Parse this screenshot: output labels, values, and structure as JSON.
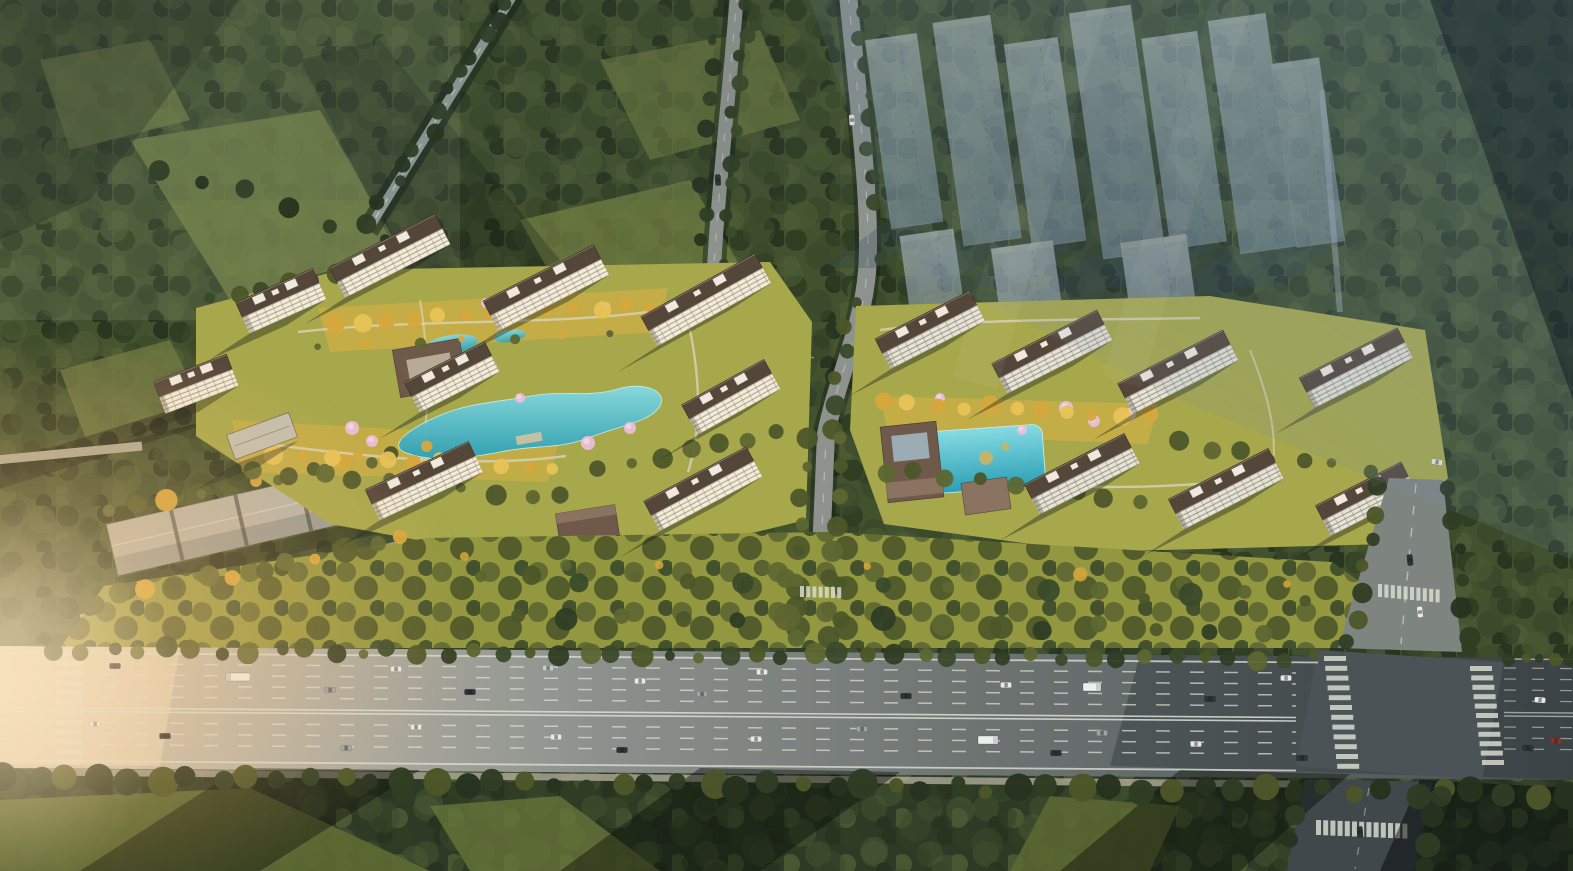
{
  "meta": {
    "description": "Aerial dusk rendering of a residential development: two clusters of high-rise apartment towers with dark hip roofs around landscaped courtyard gardens with serpentine turquoise ponds, golden trees and pink blossom trees; translucent phase-two tower massing at upper right; dense forest surroundings; long low storage rows at left; a wide multi-lane highway across the bottom with cars, trucks and zebra crosswalks, and a signalized intersection at the right; warm low sunlight from the left."
  },
  "palette": {
    "forest_base": "#42512e",
    "forest_deep": "#2f3d24",
    "forest_shade": "#27331f",
    "forest_mid": "#3a4a2a",
    "forest_light": "#4a5a33",
    "forest_south": "#2c3a26",
    "meadow": "#6d7a41",
    "canopy_olive": "#5d6632",
    "canopy_dark": "#4c5629",
    "tree_gold": "#d7a63c",
    "tree_gold_light": "#e7c257",
    "blossom": "#e9c0da",
    "blossom_light": "#f3d6e8",
    "lawn": "#a7a74b",
    "lawn_gold": "#c9ae45",
    "park": "#93973f",
    "grass_south": "#5d6a33",
    "pond_hi": "#86dbe2",
    "pond_lo": "#2b9fb6",
    "facade_warm": "#f3ecda",
    "facade_cool": "#e7e3d6",
    "facade_line": "#9f9580",
    "roof_brown": "#55463a",
    "roof_dark": "#3a2f27",
    "roof_box": "#efeadd",
    "podium": "#c3bfae",
    "garage_roof": "#b6b4a8",
    "garage_shade": "#8e948f",
    "gate_brown": "#6e594a",
    "gate_light": "#8a7361",
    "road": "#8d928e",
    "road_pale": "#b8b2a2",
    "canal": "#8d9a94",
    "hw_left": "#d8cfba",
    "hw_mid": "#8d918d",
    "hw_right": "#4a5254",
    "intersection": "#4b5356",
    "lane": "#dcdfd3",
    "ghost_hi": "#c7d2da",
    "ghost_lo": "#8196a9",
    "ghost_shadow": "#2c3e52",
    "car_white": "#e9ebe3",
    "car_dark": "#2d3336",
    "car_gray": "#9da3a4",
    "car_silver": "#c6cac8",
    "car_red": "#8a3430",
    "glow": "#ffc98a",
    "haze": "#6e8cab"
  },
  "scene": {
    "towers": [
      {
        "x": 390,
        "y": 256,
        "l": 118,
        "rot": -27,
        "s": "warm"
      },
      {
        "x": 546,
        "y": 288,
        "l": 124,
        "rot": -27,
        "s": "warm"
      },
      {
        "x": 706,
        "y": 300,
        "l": 130,
        "rot": -29,
        "s": "warm"
      },
      {
        "x": 281,
        "y": 301,
        "l": 84,
        "rot": -24,
        "s": "warm"
      },
      {
        "x": 196,
        "y": 384,
        "l": 78,
        "rot": -21,
        "s": "warm"
      },
      {
        "x": 452,
        "y": 377,
        "l": 90,
        "rot": -27,
        "s": "warm"
      },
      {
        "x": 731,
        "y": 397,
        "l": 94,
        "rot": -29,
        "s": "warm"
      },
      {
        "x": 424,
        "y": 481,
        "l": 114,
        "rot": -25,
        "s": "warm"
      },
      {
        "x": 703,
        "y": 489,
        "l": 116,
        "rot": -28,
        "s": "warm"
      },
      {
        "x": 262,
        "y": 436,
        "l": 66,
        "rot": -20,
        "s": "podium"
      },
      {
        "x": 930,
        "y": 330,
        "l": 106,
        "rot": -27,
        "s": "cool"
      },
      {
        "x": 1052,
        "y": 352,
        "l": 118,
        "rot": -27,
        "s": "cool"
      },
      {
        "x": 1178,
        "y": 372,
        "l": 118,
        "rot": -27,
        "s": "cool"
      },
      {
        "x": 1356,
        "y": 368,
        "l": 110,
        "rot": -27,
        "s": "cool"
      },
      {
        "x": 1082,
        "y": 474,
        "l": 112,
        "rot": -27,
        "s": "cool"
      },
      {
        "x": 1226,
        "y": 489,
        "l": 112,
        "rot": -27,
        "s": "cool"
      },
      {
        "x": 1366,
        "y": 499,
        "l": 96,
        "rot": -27,
        "s": "cool"
      }
    ],
    "ghost_towers": [
      [
        878,
        36,
        52,
        190
      ],
      [
        948,
        18,
        58,
        225
      ],
      [
        1018,
        40,
        54,
        205
      ],
      [
        1086,
        8,
        62,
        248
      ],
      [
        1156,
        34,
        56,
        212
      ],
      [
        1224,
        16,
        58,
        235
      ],
      [
        1284,
        60,
        48,
        185
      ],
      [
        1130,
        238,
        66,
        140
      ],
      [
        1000,
        244,
        62,
        132
      ],
      [
        908,
        232,
        54,
        124
      ]
    ],
    "tree_rows": [
      {
        "layer": "roadside",
        "x0": 55,
        "y0": 649,
        "x1": 1315,
        "y1": 659,
        "n": 46,
        "r": 8,
        "j": 5,
        "colors": [
          "forest_mid",
          "canopy_dark",
          "forest_deep",
          "canopy_olive"
        ]
      },
      {
        "layer": "roadside",
        "x0": 1510,
        "y0": 660,
        "x1": 1570,
        "y1": 661,
        "n": 5,
        "r": 7,
        "j": 3,
        "colors": [
          "forest_deep",
          "canopy_dark"
        ]
      },
      {
        "layer": "roadside",
        "x0": 6,
        "y0": 778,
        "x1": 1568,
        "y1": 794,
        "n": 52,
        "r": 11,
        "j": 6,
        "colors": [
          "forest_shade",
          "forest_deep",
          "canopy_dark"
        ],
        "o": 0.98
      },
      {
        "layer": "forest",
        "x0": 508,
        "y0": 2,
        "x1": 372,
        "y1": 222,
        "n": 13,
        "r": 8,
        "j": 7,
        "colors": [
          "forest_deep",
          "forest_shade"
        ]
      },
      {
        "layer": "forest",
        "x0": 744,
        "y0": 6,
        "x1": 722,
        "y1": 288,
        "n": 12,
        "r": 7,
        "j": 6,
        "colors": [
          "forest_deep",
          "forest_mid"
        ]
      },
      {
        "layer": "forest",
        "x0": 712,
        "y0": 12,
        "x1": 700,
        "y1": 270,
        "n": 10,
        "r": 7,
        "j": 6,
        "colors": [
          "forest_shade",
          "forest_deep"
        ]
      },
      {
        "layer": "forest",
        "x0": 858,
        "y0": 8,
        "x1": 880,
        "y1": 258,
        "n": 10,
        "r": 7,
        "j": 6,
        "colors": [
          "forest_deep",
          "forest_mid"
        ]
      },
      {
        "layer": "forest",
        "x0": 852,
        "y0": 300,
        "x1": 830,
        "y1": 428,
        "n": 6,
        "r": 8,
        "j": 5,
        "colors": [
          "forest_mid",
          "canopy_dark"
        ]
      },
      {
        "layer": "forest",
        "x0": 6,
        "y0": 470,
        "x1": 212,
        "y1": 410,
        "n": 9,
        "r": 9,
        "j": 5,
        "colors": [
          "forest_shade",
          "forest_deep"
        ]
      },
      {
        "layer": "forest",
        "x0": 160,
        "y0": 170,
        "x1": 420,
        "y1": 250,
        "n": 7,
        "r": 8,
        "j": 10,
        "colors": [
          "forest_deep",
          "forest_shade"
        ]
      },
      {
        "layer": "garden",
        "x0": 840,
        "y0": 440,
        "x1": 830,
        "y1": 636,
        "n": 8,
        "r": 8,
        "j": 4,
        "colors": [
          "canopy_olive",
          "canopy_dark"
        ]
      },
      {
        "layer": "garden",
        "x0": 806,
        "y0": 440,
        "x1": 796,
        "y1": 636,
        "n": 8,
        "r": 8,
        "j": 4,
        "colors": [
          "canopy_dark",
          "canopy_olive"
        ]
      },
      {
        "layer": "garden",
        "x0": 112,
        "y0": 512,
        "x1": 424,
        "y1": 448,
        "n": 12,
        "r": 8,
        "j": 5,
        "colors": [
          "canopy_olive",
          "canopy_dark",
          "tree_gold"
        ]
      },
      {
        "layer": "garden",
        "x0": 92,
        "y0": 602,
        "x1": 402,
        "y1": 540,
        "n": 12,
        "r": 9,
        "j": 5,
        "colors": [
          "canopy_dark",
          "canopy_olive",
          "tree_gold"
        ]
      },
      {
        "layer": "garden",
        "x0": 214,
        "y0": 302,
        "x1": 336,
        "y1": 272,
        "n": 6,
        "r": 8,
        "j": 5,
        "colors": [
          "forest_mid",
          "canopy_dark"
        ]
      },
      {
        "layer": "garden",
        "x0": 252,
        "y0": 470,
        "x1": 564,
        "y1": 498,
        "n": 10,
        "r": 8,
        "j": 5,
        "colors": [
          "canopy_olive",
          "canopy_dark"
        ]
      },
      {
        "layer": "garden",
        "x0": 600,
        "y0": 470,
        "x1": 780,
        "y1": 432,
        "n": 7,
        "r": 8,
        "j": 5,
        "colors": [
          "canopy_dark",
          "canopy_olive"
        ]
      },
      {
        "layer": "garden",
        "x0": 884,
        "y0": 470,
        "x1": 1140,
        "y1": 500,
        "n": 9,
        "r": 8,
        "j": 5,
        "colors": [
          "canopy_olive",
          "canopy_dark"
        ]
      },
      {
        "layer": "garden",
        "x0": 1180,
        "y0": 442,
        "x1": 1366,
        "y1": 470,
        "n": 7,
        "r": 8,
        "j": 5,
        "colors": [
          "canopy_dark",
          "canopy_olive"
        ]
      },
      {
        "layer": "south",
        "x0": 480,
        "y0": 575,
        "x1": 1300,
        "y1": 598,
        "n": 17,
        "r": 9,
        "j": 7,
        "colors": [
          "canopy_olive",
          "canopy_dark",
          "forest_mid"
        ]
      },
      {
        "layer": "south",
        "x0": 520,
        "y0": 612,
        "x1": 1260,
        "y1": 634,
        "n": 15,
        "r": 10,
        "j": 7,
        "colors": [
          "canopy_dark",
          "forest_deep",
          "canopy_olive"
        ]
      },
      {
        "layer": "gold",
        "x0": 334,
        "y0": 322,
        "x1": 654,
        "y1": 306,
        "n": 13,
        "r": 7,
        "j": 4,
        "colors": [
          "tree_gold",
          "tree_gold_light",
          "tree_gold"
        ]
      },
      {
        "layer": "gold",
        "x0": 246,
        "y0": 452,
        "x1": 556,
        "y1": 468,
        "n": 12,
        "r": 8,
        "j": 4,
        "colors": [
          "tree_gold",
          "tree_gold_light"
        ]
      },
      {
        "layer": "gold",
        "x0": 884,
        "y0": 402,
        "x1": 1148,
        "y1": 416,
        "n": 11,
        "r": 7,
        "j": 4,
        "colors": [
          "tree_gold",
          "tree_gold_light"
        ]
      },
      {
        "layer": "gold",
        "x0": 320,
        "y0": 345,
        "x1": 660,
        "y1": 330,
        "n": 8,
        "r": 5,
        "j": 5,
        "colors": [
          "canopy_olive",
          "tree_gold"
        ]
      },
      {
        "layer": "gold",
        "x0": 460,
        "y0": 556,
        "x1": 1280,
        "y1": 582,
        "n": 9,
        "r": 6,
        "j": 8,
        "colors": [
          "tree_gold",
          "canopy_olive"
        ],
        "o": 0.85
      },
      {
        "layer": "roadside",
        "x0": 1380,
        "y0": 486,
        "x1": 1350,
        "y1": 644,
        "n": 7,
        "r": 8,
        "j": 4,
        "colors": [
          "forest_deep",
          "canopy_dark"
        ]
      },
      {
        "layer": "roadside",
        "x0": 1450,
        "y0": 488,
        "x1": 1468,
        "y1": 640,
        "n": 6,
        "r": 8,
        "j": 4,
        "colors": [
          "forest_shade",
          "forest_deep"
        ]
      },
      {
        "layer": "roadside",
        "x0": 1296,
        "y0": 792,
        "x1": 1282,
        "y1": 866,
        "n": 4,
        "r": 9,
        "j": 4,
        "colors": [
          "forest_shade",
          "forest_deep"
        ]
      },
      {
        "layer": "roadside",
        "x0": 1440,
        "y0": 794,
        "x1": 1426,
        "y1": 866,
        "n": 4,
        "r": 9,
        "j": 4,
        "colors": [
          "forest_deep",
          "forest_shade"
        ]
      }
    ],
    "blossoms": [
      [
        352,
        428,
        7
      ],
      [
        372,
        441,
        6
      ],
      [
        588,
        443,
        7
      ],
      [
        630,
        428,
        6
      ],
      [
        486,
        303,
        5
      ],
      [
        520,
        398,
        5
      ],
      [
        940,
        398,
        5
      ],
      [
        1066,
        408,
        7
      ],
      [
        1094,
        421,
        6
      ],
      [
        1130,
        414,
        6
      ],
      [
        1022,
        430,
        5
      ],
      [
        606,
        306,
        4
      ]
    ],
    "crosswalks": [
      {
        "x": 56,
        "y": 651,
        "dx": 0,
        "dy": 9.8,
        "n": 12,
        "w": 26,
        "h": 5
      },
      {
        "x": 1324,
        "y": 656,
        "dx": 1.2,
        "dy": 9.8,
        "n": 12,
        "w": 22,
        "h": 5
      },
      {
        "x": 1470,
        "y": 666,
        "dx": 1.2,
        "dy": 9.4,
        "n": 11,
        "w": 22,
        "h": 5
      },
      {
        "x": 1378,
        "y": 584,
        "dx": 6.4,
        "dy": 0.6,
        "n": 10,
        "w": 4,
        "h": 13
      },
      {
        "x": 1316,
        "y": 820,
        "dx": 7.2,
        "dy": 0.3,
        "n": 13,
        "w": 5,
        "h": 15
      },
      {
        "x": 800,
        "y": 586,
        "dx": 6.2,
        "dy": 0.2,
        "n": 7,
        "w": 4,
        "h": 11
      }
    ],
    "vehicles": {
      "cars": [
        [
          115,
          666,
          "car_dark"
        ],
        [
          330,
          690,
          "car_gray"
        ],
        [
          396,
          669,
          "car_white"
        ],
        [
          470,
          692,
          "car_dark"
        ],
        [
          548,
          668,
          "car_silver"
        ],
        [
          640,
          681,
          "car_white"
        ],
        [
          702,
          694,
          "car_gray"
        ],
        [
          762,
          672,
          "car_white"
        ],
        [
          906,
          696,
          "car_dark"
        ],
        [
          1006,
          685,
          "car_white"
        ],
        [
          1210,
          699,
          "car_dark"
        ],
        [
          1286,
          678,
          "car_white"
        ],
        [
          95,
          724,
          "car_white"
        ],
        [
          165,
          736,
          "car_dark"
        ],
        [
          346,
          748,
          "car_gray"
        ],
        [
          416,
          727,
          "car_white"
        ],
        [
          556,
          737,
          "car_white"
        ],
        [
          622,
          750,
          "car_dark"
        ],
        [
          756,
          739,
          "car_white"
        ],
        [
          862,
          729,
          "car_gray"
        ],
        [
          1056,
          753,
          "car_dark"
        ],
        [
          1102,
          733,
          "car_gray"
        ],
        [
          1196,
          744,
          "car_white"
        ],
        [
          1302,
          758,
          "car_dark"
        ],
        [
          1410,
          560,
          "car_dark",
          84
        ],
        [
          1420,
          612,
          "car_white",
          84
        ],
        [
          1540,
          700,
          "car_white",
          4
        ],
        [
          1528,
          748,
          "car_dark",
          4
        ],
        [
          1556,
          741,
          "car_red",
          4
        ],
        [
          1360,
          832,
          "car_dark",
          86
        ],
        [
          852,
          120,
          "car_white",
          87
        ],
        [
          718,
          180,
          "car_dark",
          88
        ],
        [
          1437,
          462,
          "car_white",
          10
        ]
      ],
      "trucks": [
        [
          238,
          677,
          24,
          -1
        ],
        [
          988,
          740,
          20,
          1
        ],
        [
          1092,
          687,
          18,
          1
        ]
      ]
    }
  }
}
